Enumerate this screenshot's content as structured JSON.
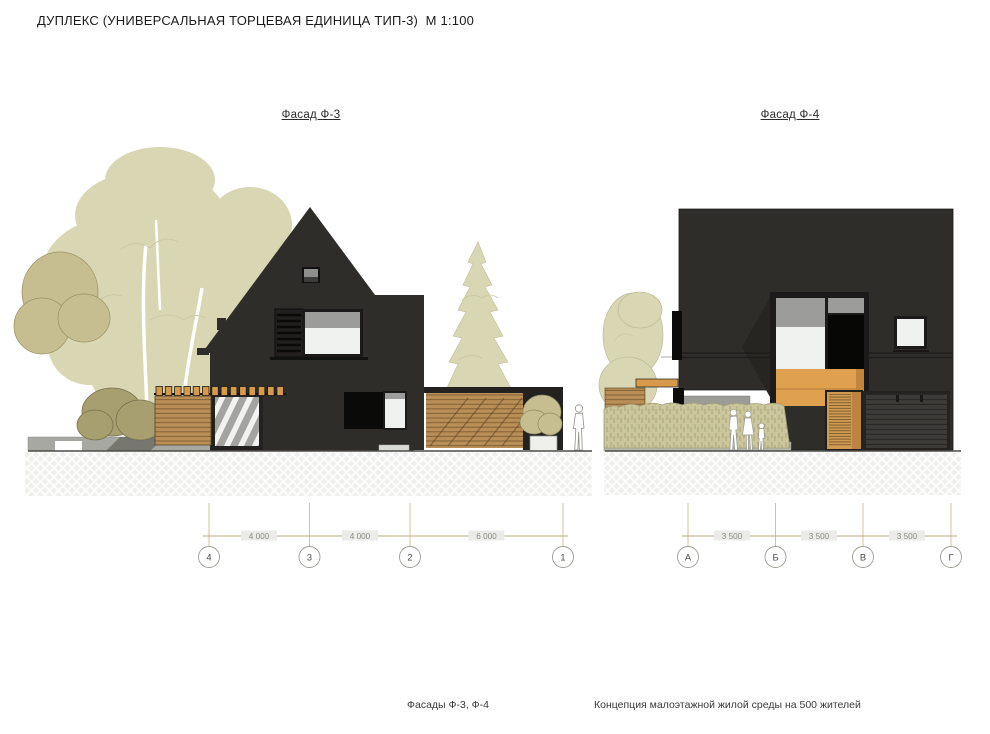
{
  "title": "ДУПЛЕКС (УНИВЕРСАЛЬНАЯ ТОРЦЕВАЯ ЕДИНИЦА ТИП-3)  М 1:100",
  "facade_left": {
    "label": "Фасад Ф-3",
    "axes": [
      "4",
      "3",
      "2",
      "1"
    ],
    "dims": [
      "4 000",
      "4 000",
      "6 000"
    ]
  },
  "facade_right": {
    "label": "Фасад Ф-4",
    "axes": [
      "А",
      "Б",
      "В",
      "Г"
    ],
    "dims": [
      "3 500",
      "3 500",
      "3 500"
    ]
  },
  "footer": {
    "drawing_caption": "Фасады Ф-3, Ф-4",
    "project_caption": "Концепция малоэтажной жилой среды на 500 жителей"
  },
  "colors": {
    "house": "#2e2d2a",
    "tree_light": "#d9d6b3",
    "tree_olive": "#c6be90",
    "bush_dark": "#a89f70",
    "hedge": "#cbc69c",
    "wood_slat": "#b98e57",
    "wood_beam": "#d79a4b",
    "panel_orange": "#dfa050",
    "window_white": "#eef1ed",
    "window_gray": "#9c9c9a",
    "window_black": "#0a0a09",
    "pavement": "#b7b7b2",
    "dim_line": "#c9bf8e",
    "dim_text": "#8b8b85",
    "ground_line": "#4c4b46"
  }
}
